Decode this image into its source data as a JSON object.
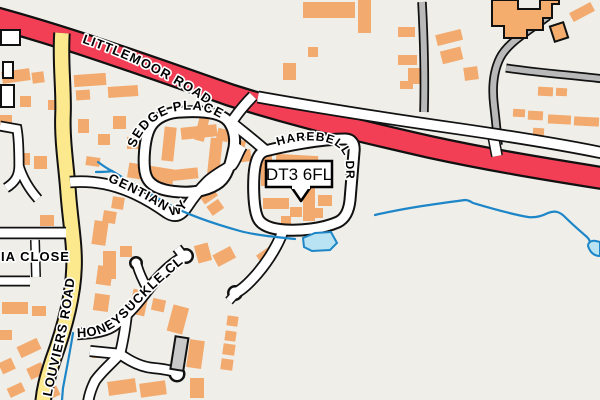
{
  "map": {
    "type": "street-map",
    "postcode_marker": {
      "label": "DT3 6FL"
    },
    "street_labels": {
      "littlemoor_road": "LITTLEMOOR ROAD",
      "sedge_place": "SEDGE PLACE",
      "harebell_drive": "HAREBELL DR",
      "gentian_way": "GENTIAN WY",
      "ia_close": "IA CLOSE",
      "louviers_road": "LOUVIERS ROAD",
      "honeysuckle_close": "HONEYSUCKLE CL"
    },
    "colors": {
      "background": "#efeee8",
      "primary_road": "#f23f55",
      "secondary_road": "#fce98e",
      "minor_road": "#ffffff",
      "service_road": "#b9b9b9",
      "road_casing": "#111111",
      "building": "#f2aa6e",
      "building_outlined": "#f5ad6e",
      "special_building": "#ffffff",
      "garage_building": "#c9c9c9",
      "water": "#1d86c8",
      "water_fill": "#b9e3f2",
      "label_text": "#000000",
      "label_halo": "#ffffff",
      "marker_bg": "#ffffff",
      "marker_border": "#000000"
    }
  }
}
